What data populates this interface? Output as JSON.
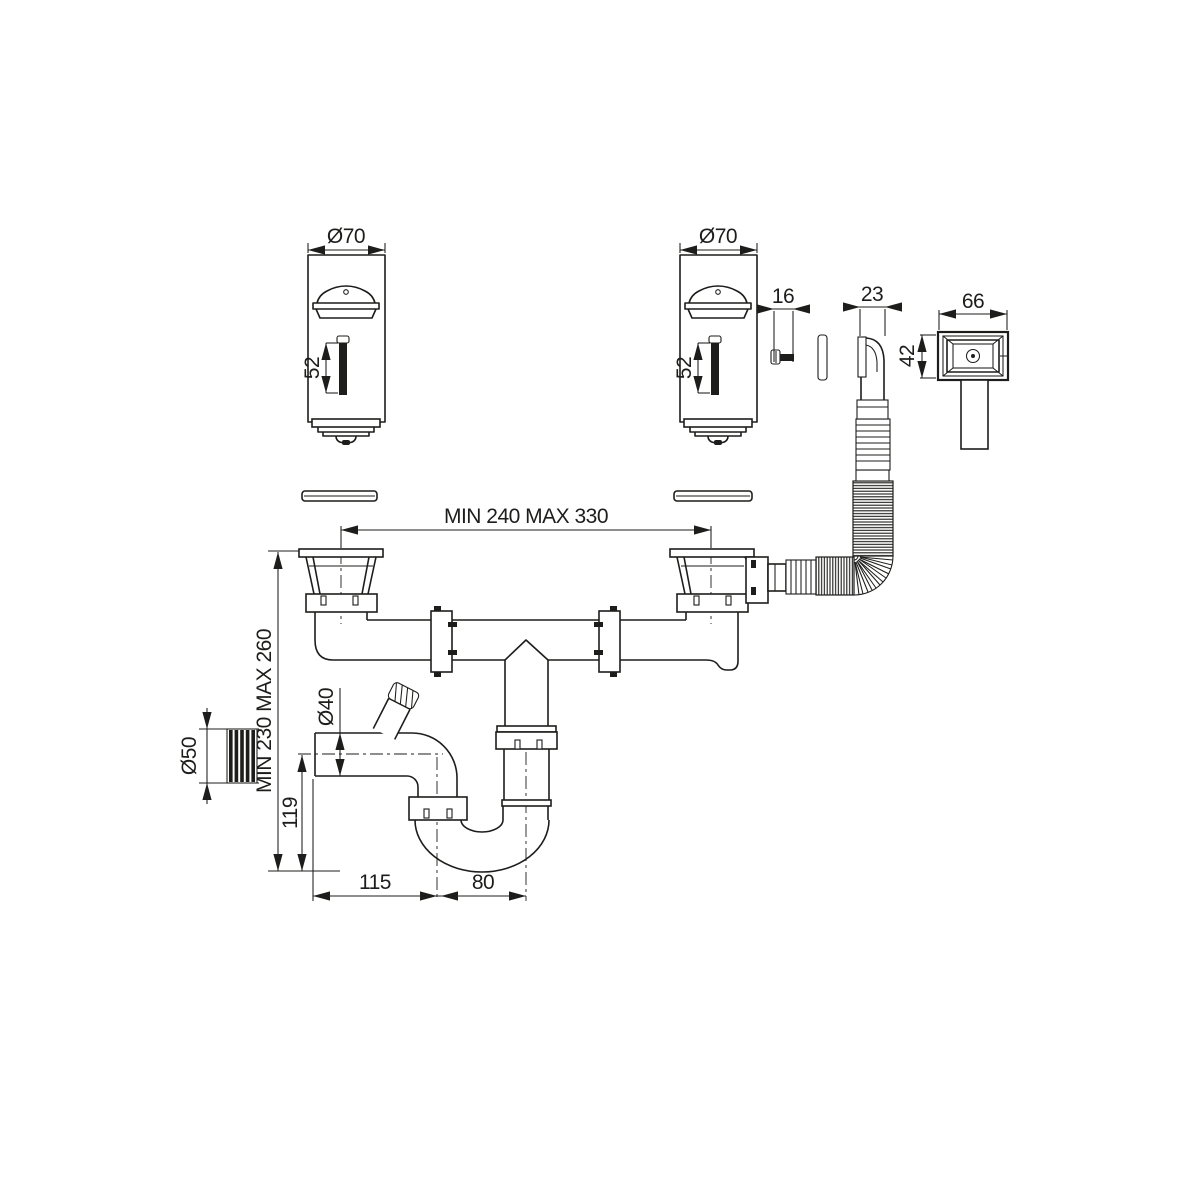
{
  "drawing": {
    "background": "#ffffff",
    "line_color": "#1d1d1b",
    "labels": {
      "strainer_diameter_left": "Ø70",
      "strainer_diameter_right": "Ø70",
      "plug_length_left": "52",
      "plug_length_right": "52",
      "screw_length": "16",
      "overflow_elbow_width": "23",
      "overflow_cover_width": "66",
      "overflow_cover_height": "42",
      "bowl_center_distance": "MIN 240 MAX 330",
      "installation_height": "MIN 230 MAX 260",
      "outlet_diameter": "Ø50",
      "waste_pipe_diameter": "Ø40",
      "trap_inlet_height": "119",
      "trap_horizontal_run": "115",
      "trap_bend_run": "80"
    }
  }
}
